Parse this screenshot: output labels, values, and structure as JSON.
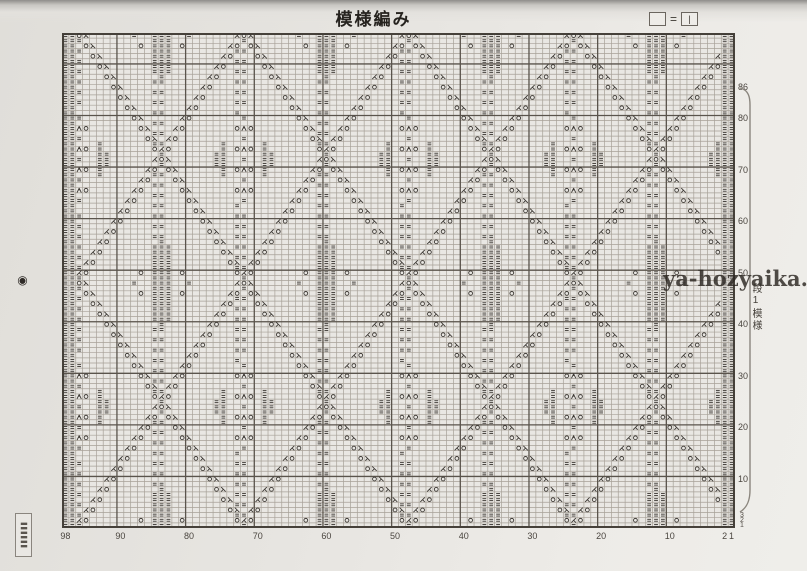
{
  "page": {
    "title": "模様編み",
    "watermark": "ya-hozyaika.com"
  },
  "legend": {
    "blank_box": "",
    "equals": "=",
    "knit_bar": "|"
  },
  "stamps": {
    "circle": "◉",
    "box_text": "〓〓〓"
  },
  "chart": {
    "type": "knitting-chart",
    "stitches": 98,
    "rows": 96,
    "major_grid_every": 10,
    "bottom_stitch_numbers": [
      98,
      90,
      80,
      70,
      60,
      50,
      40,
      30,
      20,
      10,
      2,
      1
    ],
    "right_row_numbers": [
      86,
      80,
      70,
      60,
      50,
      40,
      30,
      20,
      10
    ],
    "right_row_numbers_small": [
      3,
      2,
      1
    ],
    "repeat_label": "段1模様",
    "repeat_rows": 86,
    "symbols": {
      "purl": "=",
      "yarn_over": "○",
      "k2tog": "⋌",
      "ssk": "⋋",
      "cdd": "人",
      "slant_left": "/",
      "slant_right": "\\"
    },
    "colors": {
      "paper": "#e9e7e3",
      "grid": "#a39d94",
      "grid_major": "#5a544c",
      "border": "#46413a",
      "symbol": "#3c3833",
      "bracket": "#8b867e"
    }
  }
}
